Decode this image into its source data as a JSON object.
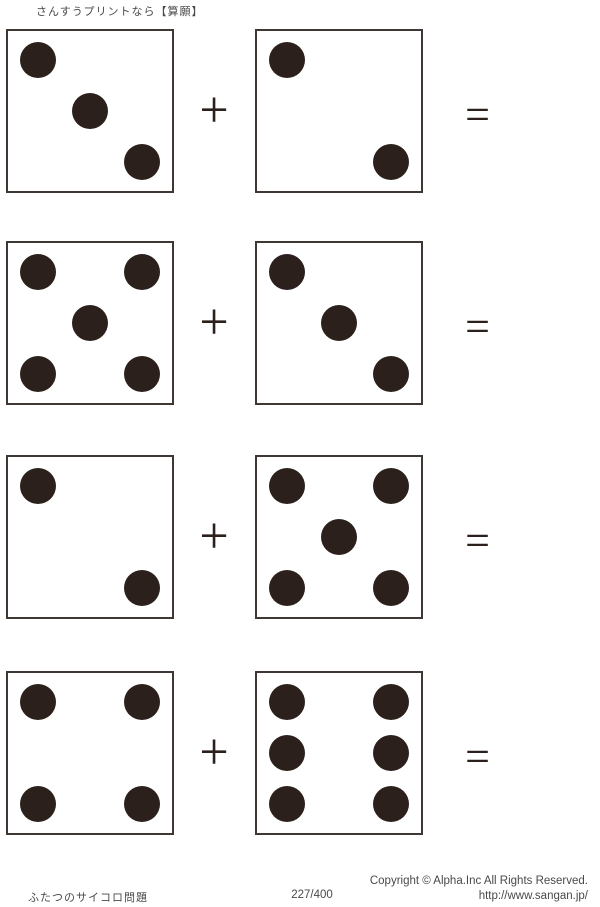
{
  "header": {
    "title": "さんすうプリントなら【算願】"
  },
  "operators": {
    "plus": "+",
    "equals": "="
  },
  "problems": [
    {
      "left": 3,
      "right": 2
    },
    {
      "left": 5,
      "right": 3
    },
    {
      "left": 2,
      "right": 5
    },
    {
      "left": 4,
      "right": 6
    }
  ],
  "footer": {
    "title": "ふたつのサイコロ問題",
    "page_number": "227/400",
    "copyright": "Copyright ©  Alpha.Inc All Rights Reserved.",
    "url": "http://www.sangan.jp/"
  },
  "colors": {
    "pip": "#2b201c",
    "die_border": "#3e3733",
    "text": "#4a4a4a"
  }
}
